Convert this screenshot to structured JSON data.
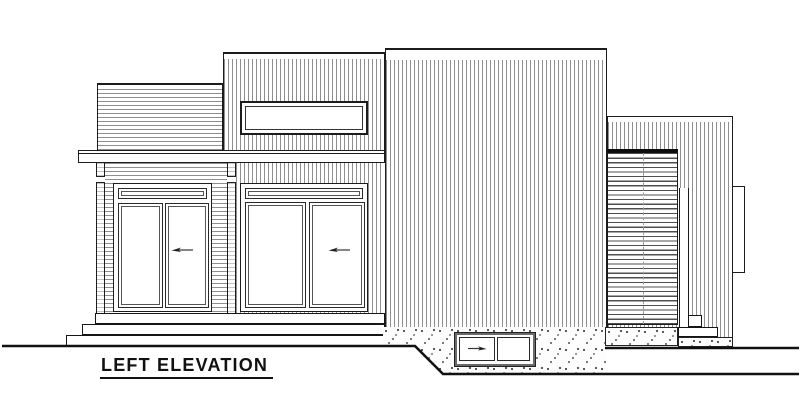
{
  "drawing": {
    "title": "LEFT ELEVATION"
  },
  "colors": {
    "background": "#ffffff",
    "outline": "#1c1c1c",
    "siding_line": "#8f8f8f",
    "louver_line": "#4f4f4f",
    "ground_line": "#111111"
  },
  "icons": {
    "sliding_door_arrow": "left-pointing slide-direction arrow",
    "basement_window_arrow": "right-pointing slide-direction arrow"
  }
}
